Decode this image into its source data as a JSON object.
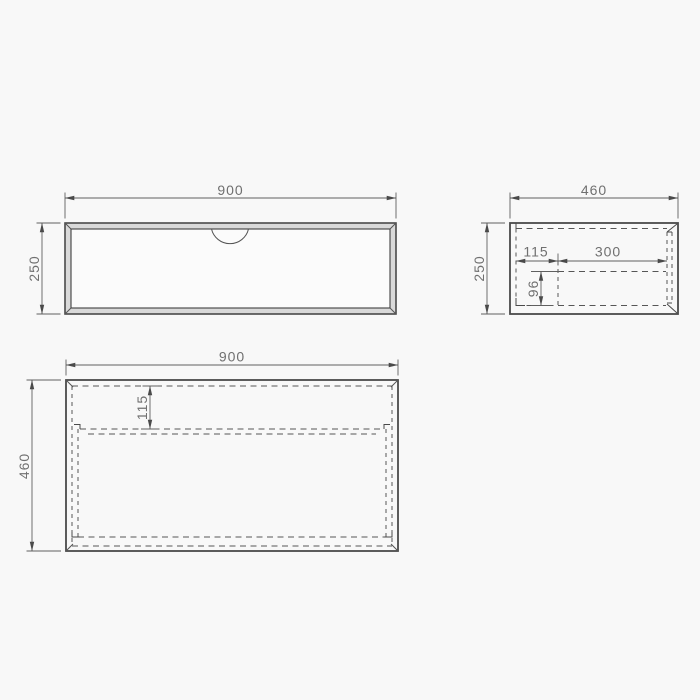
{
  "page": {
    "background_color": "#f8f8f8",
    "line_color": "#4a4a4a",
    "hidden_line_color": "#565656",
    "dimension_text_color": "#707070"
  },
  "views": {
    "front": {
      "width_label": "900",
      "height_label": "250"
    },
    "side": {
      "width_label": "460",
      "height_label": "250",
      "inner_offset_label": "115",
      "inner_width_label": "300",
      "inner_height_label": "96"
    },
    "plan": {
      "width_label": "900",
      "depth_label": "460",
      "inner_offset_label": "115"
    }
  }
}
